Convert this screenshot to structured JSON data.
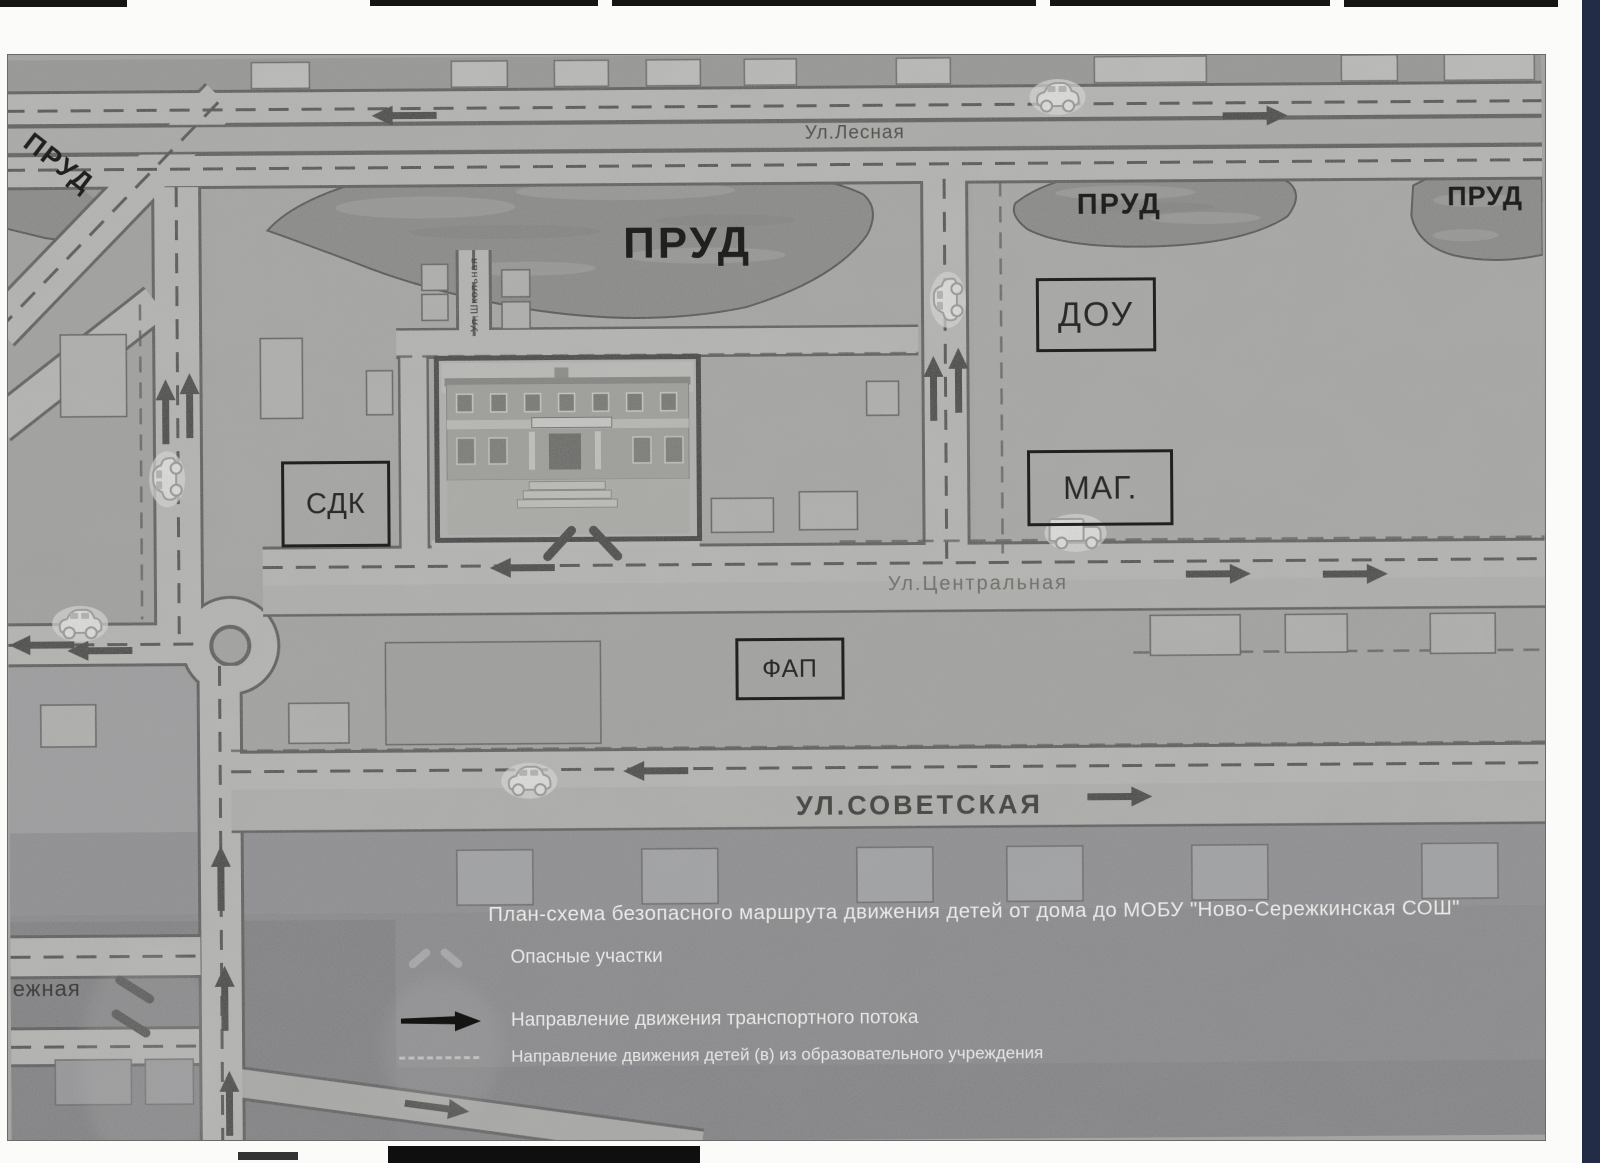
{
  "title": "План-схема безопасного маршрута движения детей от дома до МОБУ \"Ново-Сережкинская СОШ\"",
  "map": {
    "pond_label": "ПРУД",
    "streets": {
      "lesnaya": "Ул.Лесная",
      "shkolnaya": "Ул.Школьная",
      "tsentralnaya": "Ул.Центральная",
      "sovetskaya": "УЛ.СОВЕТСКАЯ",
      "naberezhnaya_partial": "ежная"
    },
    "buildings": {
      "sdk": "СДК",
      "dou": "ДОУ",
      "mag": "МАГ.",
      "fap": "ФАП"
    }
  },
  "legend": {
    "items": [
      {
        "icon": "danger-area-mark",
        "label": "Опасные участки"
      },
      {
        "icon": "traffic-flow-arrow",
        "label": "Направление движения транспортного потока"
      },
      {
        "icon": "children-route-dashes",
        "label": "Направление движения детей (в) из образовательного учреждения"
      }
    ]
  },
  "colors": {
    "map_base": "#a4a4a1",
    "road": "#bdbdb9",
    "road_edge": "#3a3a38",
    "pond": "#7a7a77",
    "legend_band": "#7b7b7f",
    "scan_edge_strip": "#232c47"
  }
}
